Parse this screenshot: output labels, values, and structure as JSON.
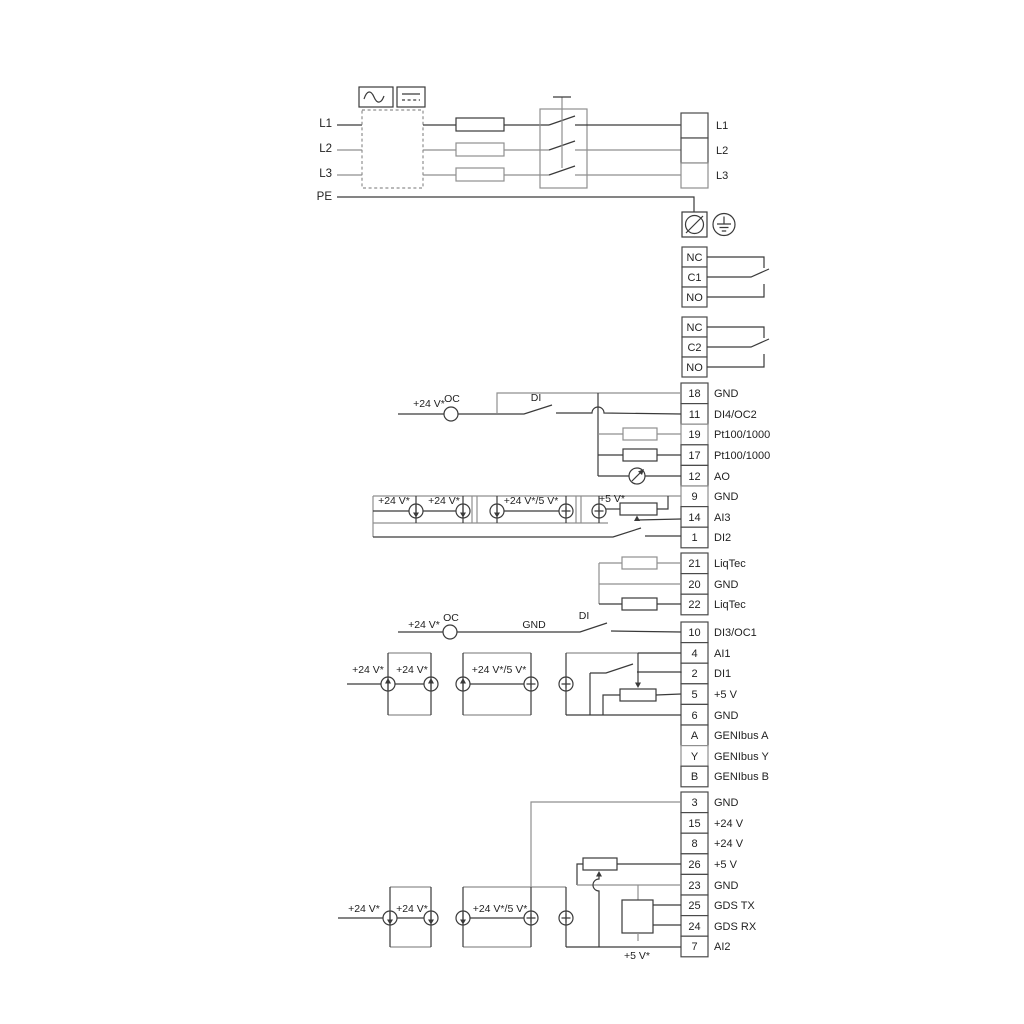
{
  "colors": {
    "wire_gray": "#8f8f8f",
    "wire_dark": "#3a3a3a",
    "text": "#1f1f1f",
    "background": "#ffffff"
  },
  "power": {
    "inputs": [
      "L1",
      "L2",
      "L3",
      "PE"
    ],
    "output_terminals": [
      "L1",
      "L2",
      "L3"
    ]
  },
  "relay1": {
    "t0": "NC",
    "t1": "C1",
    "t2": "NO"
  },
  "relay2": {
    "t0": "NC",
    "t1": "C2",
    "t2": "NO"
  },
  "strip_a": [
    {
      "no": "18",
      "label": "GND"
    },
    {
      "no": "11",
      "label": "DI4/OC2"
    },
    {
      "no": "19",
      "label": "Pt100/1000"
    },
    {
      "no": "17",
      "label": "Pt100/1000"
    },
    {
      "no": "12",
      "label": "AO"
    },
    {
      "no": "9",
      "label": "GND"
    },
    {
      "no": "14",
      "label": "AI3"
    },
    {
      "no": "1",
      "label": "DI2"
    }
  ],
  "liqtec_strip": [
    {
      "no": "21",
      "label": "LiqTec"
    },
    {
      "no": "20",
      "label": "GND"
    },
    {
      "no": "22",
      "label": "LiqTec"
    }
  ],
  "strip_b": [
    {
      "no": "10",
      "label": "DI3/OC1"
    },
    {
      "no": "4",
      "label": "AI1"
    },
    {
      "no": "2",
      "label": "DI1"
    },
    {
      "no": "5",
      "label": "+5 V"
    },
    {
      "no": "6",
      "label": "GND"
    },
    {
      "no": "A",
      "label": "GENIbus A"
    },
    {
      "no": "Y",
      "label": "GENIbus Y"
    },
    {
      "no": "B",
      "label": "GENIbus B"
    }
  ],
  "strip_c": [
    {
      "no": "3",
      "label": "GND"
    },
    {
      "no": "15",
      "label": "+24 V"
    },
    {
      "no": "8",
      "label": "+24 V"
    },
    {
      "no": "26",
      "label": "+5 V"
    },
    {
      "no": "23",
      "label": "GND"
    },
    {
      "no": "25",
      "label": "GDS TX"
    },
    {
      "no": "24",
      "label": "GDS RX"
    },
    {
      "no": "7",
      "label": "AI2"
    }
  ],
  "annotations": {
    "di4_row": {
      "supply": "+24 V*",
      "oc": "OC",
      "di": "DI"
    },
    "ai3_row": {
      "s1": "+24 V*",
      "s2": "+24 V*",
      "s3": "+24 V*/5 V*",
      "s4": "+5 V*"
    },
    "di3_row": {
      "supply": "+24 V*",
      "oc": "OC",
      "gnd": "GND",
      "di": "DI"
    },
    "ai1_row": {
      "s1": "+24 V*",
      "s2": "+24 V*",
      "s3": "+24 V*/5 V*"
    },
    "ai2_row": {
      "s1": "+24 V*",
      "s2": "+24 V*",
      "s3": "+24 V*/5 V*",
      "s4": "+5 V*"
    }
  }
}
